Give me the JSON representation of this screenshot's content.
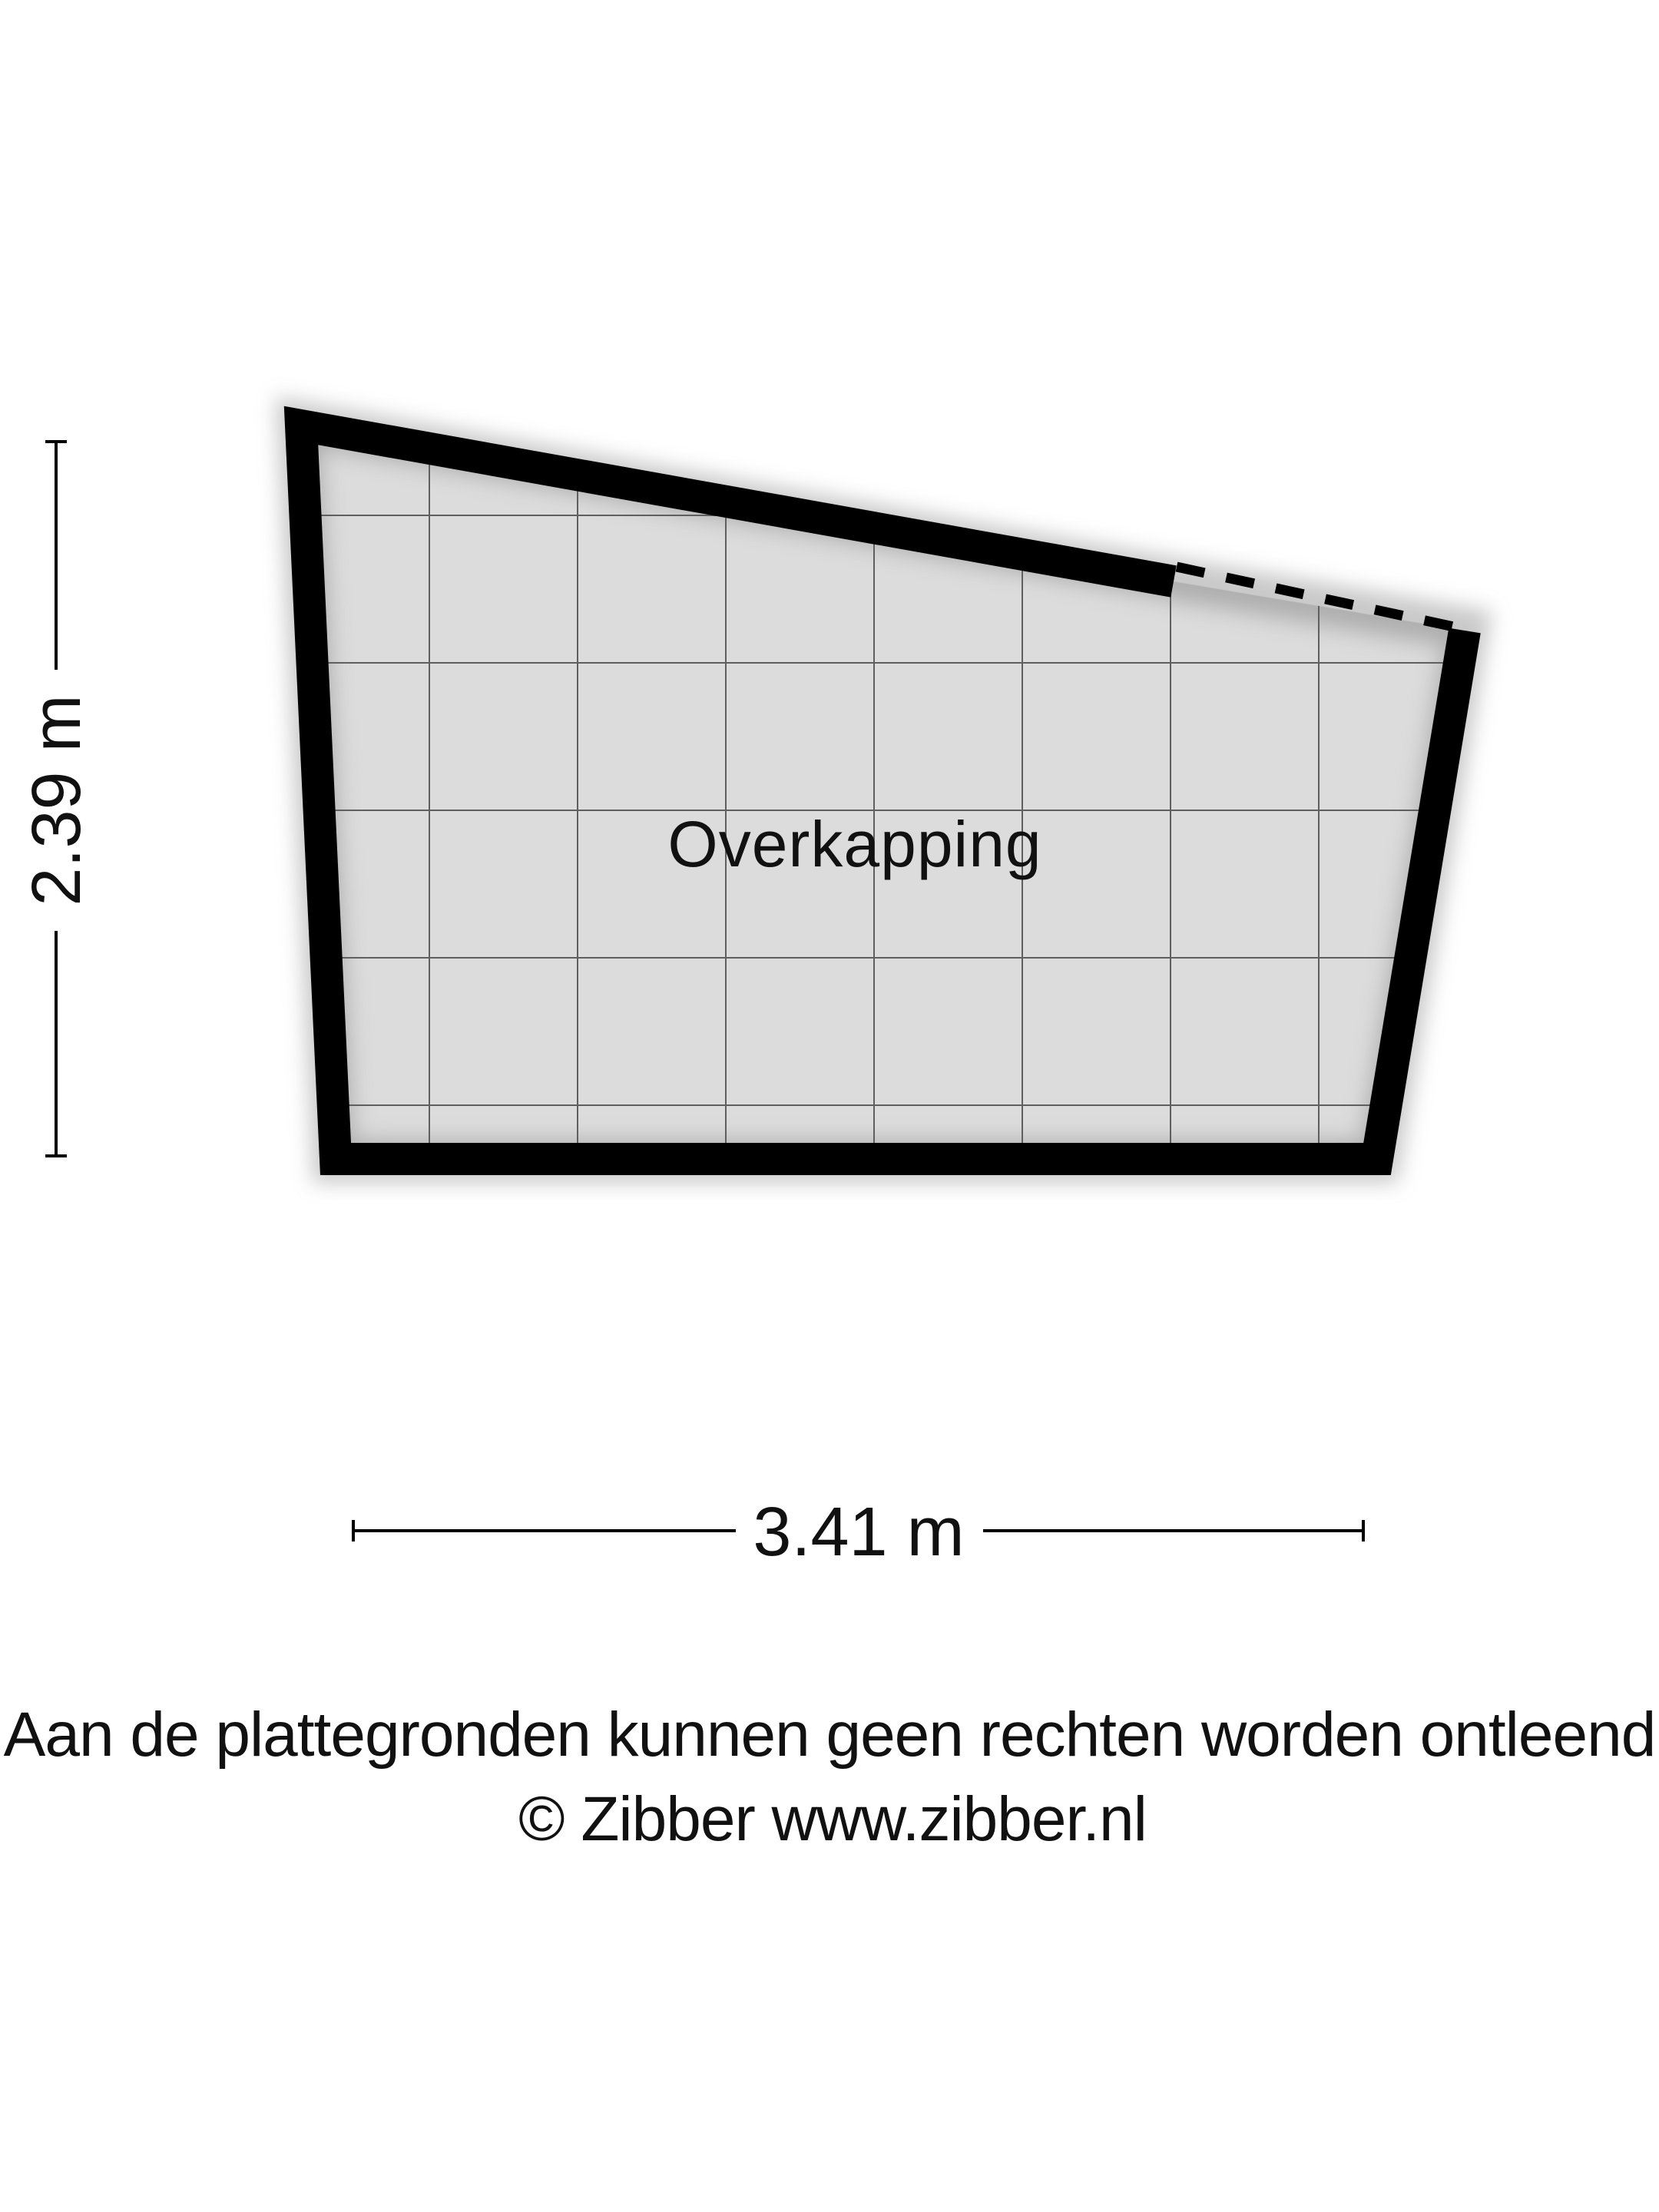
{
  "floorplan": {
    "room_label": "Overkapping",
    "dimensions": {
      "width_label": "3.41 m",
      "height_label": "2.39 m"
    }
  },
  "footer": {
    "disclaimer": "Aan de plattegronden kunnen geen rechten worden ontleend",
    "copyright": "© Zibber www.zibber.nl"
  },
  "colors": {
    "background": "#ffffff",
    "wall": "#000000",
    "floor_fill": "#dcdcdc",
    "grid_line": "#5f5f5f",
    "dimension_line": "#000000",
    "text": "#111111"
  }
}
